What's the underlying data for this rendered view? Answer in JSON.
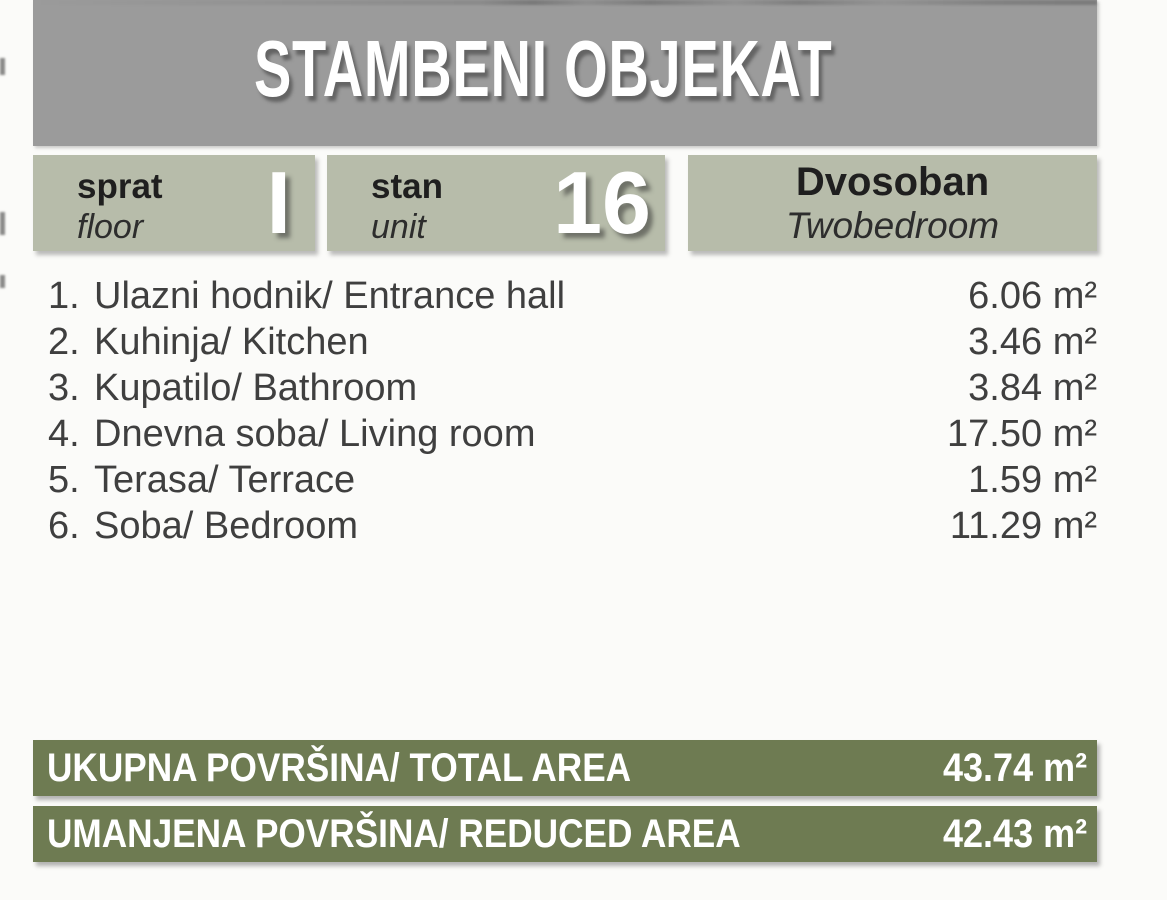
{
  "header": {
    "title": "STAMBENI OBJEKAT"
  },
  "info_boxes": {
    "floor": {
      "label_sr": "sprat",
      "label_en": "floor",
      "value": "I"
    },
    "unit": {
      "label_sr": "stan",
      "label_en": "unit",
      "value": "16"
    },
    "type": {
      "label_sr": "Dvosoban",
      "label_en": "Twobedroom"
    }
  },
  "rooms": [
    {
      "number": "1.",
      "label": "Ulazni hodnik/ Entrance hall",
      "area": "6.06 m²"
    },
    {
      "number": "2.",
      "label": "Kuhinja/ Kitchen",
      "area": "3.46 m²"
    },
    {
      "number": "3.",
      "label": "Kupatilo/ Bathroom",
      "area": "3.84 m²"
    },
    {
      "number": "4.",
      "label": "Dnevna soba/ Living room",
      "area": "17.50 m²"
    },
    {
      "number": "5.",
      "label": "Terasa/ Terrace",
      "area": "1.59 m²"
    },
    {
      "number": "6.",
      "label": "Soba/ Bedroom",
      "area": "11.29 m²"
    }
  ],
  "totals": [
    {
      "label": "UKUPNA POVRŠINA/ TOTAL AREA",
      "value": "43.74 m²"
    },
    {
      "label": "UMANJENA POVRŠINA/ REDUCED AREA",
      "value": "42.43 m²"
    }
  ],
  "colors": {
    "header_bg": "#9b9b9b",
    "box_bg": "#b7bcaa",
    "bar_bg": "#6e7b52",
    "page_bg": "#fbfbf9",
    "text_dark": "#1f1f1f",
    "text_body": "#3f3f3f",
    "text_light": "#ffffff"
  }
}
